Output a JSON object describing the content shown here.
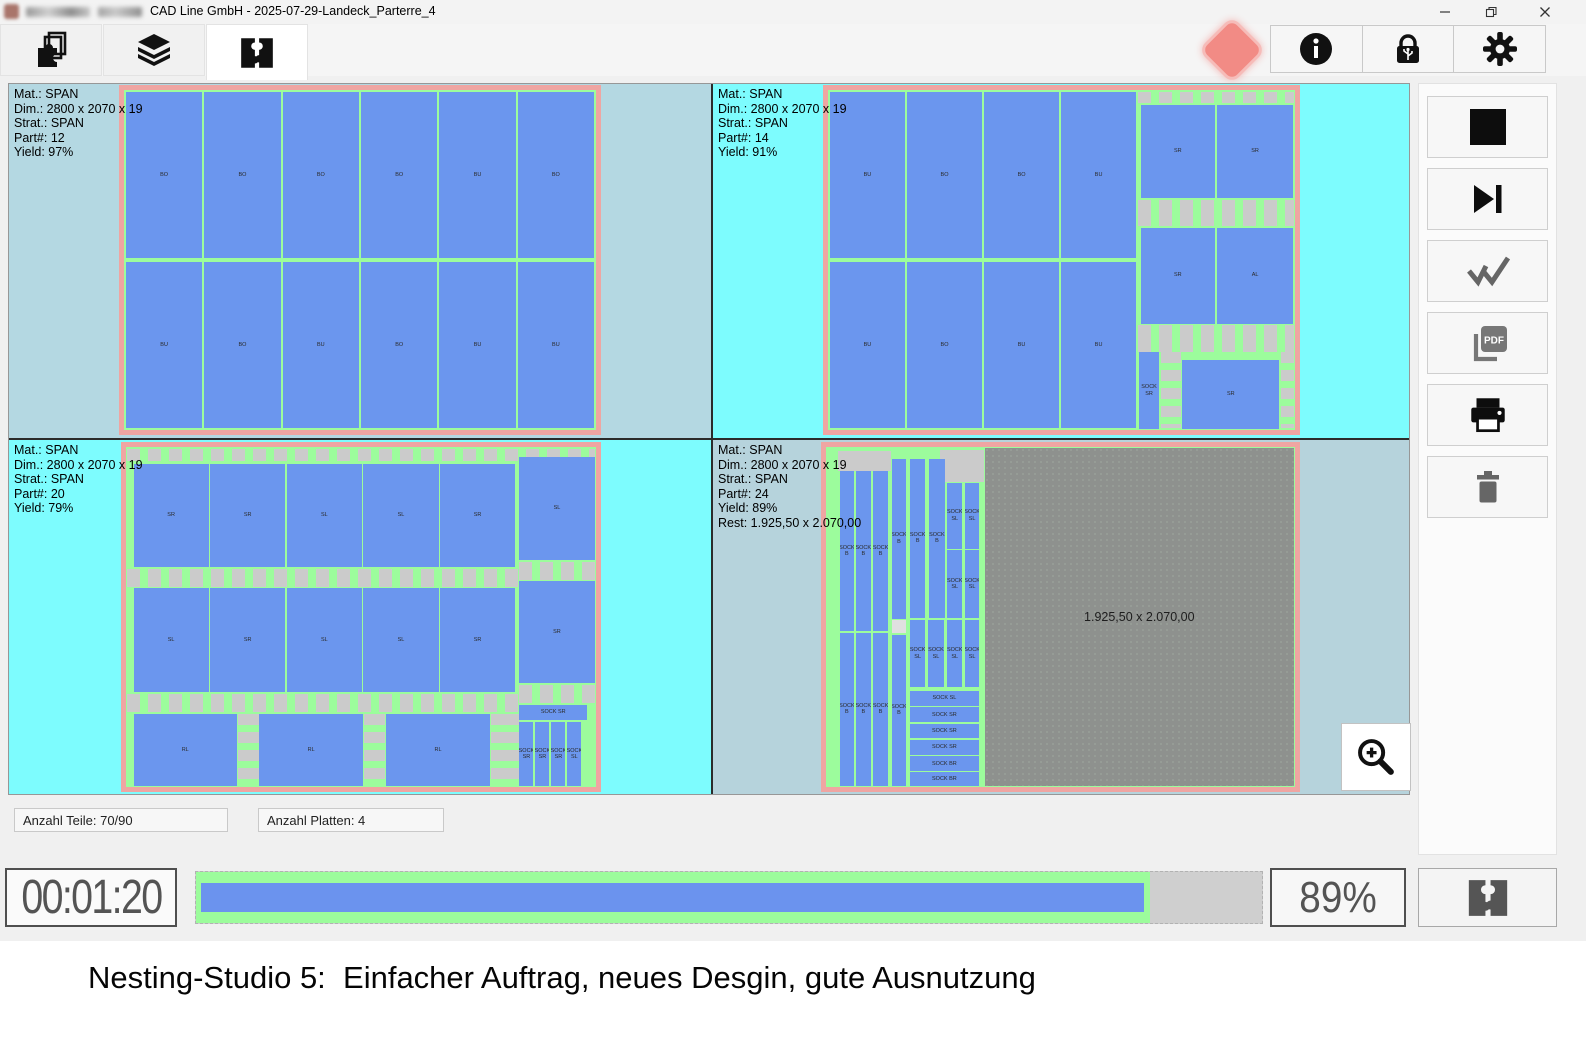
{
  "window": {
    "title": "CAD Line GmbH - 2025-07-29-Landeck_Parterre_4",
    "controls": [
      {
        "icon": "minimize-icon"
      },
      {
        "icon": "restore-icon"
      },
      {
        "icon": "close-icon"
      }
    ]
  },
  "toolbar": {
    "tabs": [
      {
        "icon": "nesting-parts-icon",
        "active": false
      },
      {
        "icon": "material-layers-icon",
        "active": false
      },
      {
        "icon": "nesting-puzzle-icon",
        "active": true
      }
    ],
    "status_indicator_color": "#f28b85",
    "buttons": [
      {
        "icon": "info-icon"
      },
      {
        "icon": "usb-lock-icon"
      },
      {
        "icon": "settings-gear-icon"
      }
    ]
  },
  "sheets": [
    {
      "info": [
        "Mat.: SPAN",
        "Dim.: 2800 x 2070 x 19",
        "Strat.: SPAN",
        "Part#: 12",
        "Yield: 97%"
      ],
      "rects": [
        {
          "t": "p",
          "x": 0.4,
          "y": 0.6,
          "w": 16.2,
          "h": 48.9,
          "l": "BO"
        },
        {
          "t": "p",
          "x": 17.0,
          "y": 0.6,
          "w": 16.2,
          "h": 48.9,
          "l": "BO"
        },
        {
          "t": "p",
          "x": 33.6,
          "y": 0.6,
          "w": 16.2,
          "h": 48.9,
          "l": "BO"
        },
        {
          "t": "p",
          "x": 50.2,
          "y": 0.6,
          "w": 16.2,
          "h": 48.9,
          "l": "BO"
        },
        {
          "t": "p",
          "x": 66.8,
          "y": 0.6,
          "w": 16.2,
          "h": 48.9,
          "l": "BU"
        },
        {
          "t": "p",
          "x": 83.4,
          "y": 0.6,
          "w": 16.2,
          "h": 48.9,
          "l": "BO"
        },
        {
          "t": "p",
          "x": 0.4,
          "y": 50.5,
          "w": 16.2,
          "h": 48.9,
          "l": "BU"
        },
        {
          "t": "p",
          "x": 17.0,
          "y": 50.5,
          "w": 16.2,
          "h": 48.9,
          "l": "BO"
        },
        {
          "t": "p",
          "x": 33.6,
          "y": 50.5,
          "w": 16.2,
          "h": 48.9,
          "l": "BU"
        },
        {
          "t": "p",
          "x": 50.2,
          "y": 50.5,
          "w": 16.2,
          "h": 48.9,
          "l": "BO"
        },
        {
          "t": "p",
          "x": 66.8,
          "y": 50.5,
          "w": 16.2,
          "h": 48.9,
          "l": "BU"
        },
        {
          "t": "p",
          "x": 83.4,
          "y": 50.5,
          "w": 16.2,
          "h": 48.9,
          "l": "BU"
        }
      ]
    },
    {
      "info": [
        "Mat.: SPAN",
        "Dim.: 2800 x 2070 x 19",
        "Strat.: SPAN",
        "Part#: 14",
        "Yield: 91%"
      ],
      "rects": [
        {
          "t": "c",
          "x": 66.4,
          "y": 0.5,
          "w": 33.3,
          "h": 3.4
        },
        {
          "t": "c",
          "x": 66.4,
          "y": 32.3,
          "w": 33.3,
          "h": 7.8
        },
        {
          "t": "c",
          "x": 66.4,
          "y": 69.1,
          "w": 33.3,
          "h": 7.9
        },
        {
          "t": "v",
          "x": 71.3,
          "y": 77.2,
          "w": 4.2,
          "h": 22.3
        },
        {
          "t": "v",
          "x": 96.9,
          "y": 77.2,
          "w": 2.8,
          "h": 22.3
        },
        {
          "t": "p",
          "x": 0.4,
          "y": 0.6,
          "w": 16.1,
          "h": 48.9,
          "l": "BU"
        },
        {
          "t": "p",
          "x": 16.9,
          "y": 0.6,
          "w": 16.1,
          "h": 48.9,
          "l": "BO"
        },
        {
          "t": "p",
          "x": 33.4,
          "y": 0.6,
          "w": 16.1,
          "h": 48.9,
          "l": "BO"
        },
        {
          "t": "p",
          "x": 49.9,
          "y": 0.6,
          "w": 16.1,
          "h": 48.9,
          "l": "BU"
        },
        {
          "t": "p",
          "x": 0.4,
          "y": 50.5,
          "w": 16.1,
          "h": 48.9,
          "l": "BU"
        },
        {
          "t": "p",
          "x": 16.9,
          "y": 50.5,
          "w": 16.1,
          "h": 48.9,
          "l": "BO"
        },
        {
          "t": "p",
          "x": 33.4,
          "y": 50.5,
          "w": 16.1,
          "h": 48.9,
          "l": "BU"
        },
        {
          "t": "p",
          "x": 49.9,
          "y": 50.5,
          "w": 16.1,
          "h": 48.9,
          "l": "BU"
        },
        {
          "t": "p",
          "x": 67.0,
          "y": 4.3,
          "w": 15.8,
          "h": 27.6,
          "l": "SR"
        },
        {
          "t": "p",
          "x": 83.3,
          "y": 4.3,
          "w": 16.3,
          "h": 27.6,
          "l": "SR"
        },
        {
          "t": "p",
          "x": 67.0,
          "y": 40.5,
          "w": 15.8,
          "h": 28.2,
          "l": "SR"
        },
        {
          "t": "p",
          "x": 83.3,
          "y": 40.5,
          "w": 16.3,
          "h": 28.2,
          "l": "AL"
        },
        {
          "t": "p",
          "x": 66.6,
          "y": 77.2,
          "w": 4.3,
          "h": 22.4,
          "l": "SOCK SR"
        },
        {
          "t": "p",
          "x": 75.9,
          "y": 79.5,
          "w": 20.7,
          "h": 20.1,
          "l": "SR"
        }
      ]
    },
    {
      "info": [
        "Mat.: SPAN",
        "Dim.: 2800 x 2070 x 19",
        "Strat.: SPAN",
        "Part#: 20",
        "Yield: 79%"
      ],
      "rects": [
        {
          "t": "c",
          "x": 0.3,
          "y": 0.5,
          "w": 99.4,
          "h": 3.7
        },
        {
          "t": "c",
          "x": 0.3,
          "y": 35.8,
          "w": 83.2,
          "h": 5.4
        },
        {
          "t": "c",
          "x": 83.7,
          "y": 33.8,
          "w": 16.0,
          "h": 5.2
        },
        {
          "t": "c",
          "x": 0.3,
          "y": 72.6,
          "w": 83.2,
          "h": 5.4
        },
        {
          "t": "c",
          "x": 83.7,
          "y": 70.0,
          "w": 16.0,
          "h": 5.2
        },
        {
          "t": "v",
          "x": 23.8,
          "y": 78.6,
          "w": 4.4,
          "h": 21.0
        },
        {
          "t": "v",
          "x": 50.6,
          "y": 78.6,
          "w": 4.6,
          "h": 21.0
        },
        {
          "t": "v",
          "x": 77.6,
          "y": 78.6,
          "w": 6.0,
          "h": 21.0
        },
        {
          "t": "p",
          "x": 1.6,
          "y": 4.9,
          "w": 16.0,
          "h": 30.3,
          "l": "SR"
        },
        {
          "t": "p",
          "x": 17.9,
          "y": 4.9,
          "w": 16.0,
          "h": 30.3,
          "l": "SR"
        },
        {
          "t": "p",
          "x": 34.2,
          "y": 4.9,
          "w": 16.0,
          "h": 30.3,
          "l": "SL"
        },
        {
          "t": "p",
          "x": 50.5,
          "y": 4.9,
          "w": 16.0,
          "h": 30.3,
          "l": "SL"
        },
        {
          "t": "p",
          "x": 66.8,
          "y": 4.9,
          "w": 16.0,
          "h": 30.3,
          "l": "SR"
        },
        {
          "t": "p",
          "x": 83.7,
          "y": 2.8,
          "w": 16.0,
          "h": 30.5,
          "l": "SL"
        },
        {
          "t": "p",
          "x": 1.6,
          "y": 41.6,
          "w": 16.0,
          "h": 30.4,
          "l": "SL"
        },
        {
          "t": "p",
          "x": 17.9,
          "y": 41.6,
          "w": 16.0,
          "h": 30.4,
          "l": "SR"
        },
        {
          "t": "p",
          "x": 34.2,
          "y": 41.6,
          "w": 16.0,
          "h": 30.4,
          "l": "SL"
        },
        {
          "t": "p",
          "x": 50.5,
          "y": 41.6,
          "w": 16.0,
          "h": 30.4,
          "l": "SL"
        },
        {
          "t": "p",
          "x": 66.8,
          "y": 41.6,
          "w": 16.0,
          "h": 30.4,
          "l": "SR"
        },
        {
          "t": "p",
          "x": 83.7,
          "y": 39.5,
          "w": 16.0,
          "h": 30.0,
          "l": "SR"
        },
        {
          "t": "p",
          "x": 1.6,
          "y": 78.6,
          "w": 22.0,
          "h": 21.0,
          "l": "RL"
        },
        {
          "t": "p",
          "x": 28.4,
          "y": 78.6,
          "w": 22.0,
          "h": 21.0,
          "l": "RL"
        },
        {
          "t": "p",
          "x": 55.4,
          "y": 78.6,
          "w": 22.0,
          "h": 21.0,
          "l": "RL"
        },
        {
          "t": "p",
          "x": 83.7,
          "y": 75.8,
          "w": 14.4,
          "h": 4.4,
          "l": "SOCK SR"
        },
        {
          "t": "p",
          "x": 83.7,
          "y": 80.8,
          "w": 3.0,
          "h": 19.0,
          "l": "SOCK SR"
        },
        {
          "t": "p",
          "x": 87.1,
          "y": 80.8,
          "w": 3.0,
          "h": 19.0,
          "l": "SOCK SR"
        },
        {
          "t": "p",
          "x": 90.5,
          "y": 80.8,
          "w": 3.0,
          "h": 19.0,
          "l": "SOCK SR"
        },
        {
          "t": "p",
          "x": 93.9,
          "y": 80.8,
          "w": 3.0,
          "h": 19.0,
          "l": "SOCK SL"
        }
      ]
    },
    {
      "info": [
        "Mat.: SPAN",
        "Dim.: 2800 x 2070 x 19",
        "Strat.: SPAN",
        "Part#: 24",
        "Yield: 89%",
        "Rest: 1.925,50 x 2.070,00"
      ],
      "rects": [
        {
          "t": "r",
          "x": 33.8,
          "y": 0.3,
          "w": 66.0,
          "h": 99.4,
          "l": "1.925,50 x 2.070,00"
        },
        {
          "t": "w",
          "x": 2.6,
          "y": 1.2,
          "w": 11.2,
          "h": 6.0
        },
        {
          "t": "w",
          "x": 24.4,
          "y": 0.8,
          "w": 9.2,
          "h": 9.6
        },
        {
          "t": "l",
          "x": 14.0,
          "y": 50.8,
          "w": 3.1,
          "h": 3.8
        },
        {
          "t": "p",
          "x": 2.9,
          "y": 7.1,
          "w": 3.1,
          "h": 46.9,
          "l": "SOCK B"
        },
        {
          "t": "p",
          "x": 6.4,
          "y": 7.1,
          "w": 3.1,
          "h": 46.9,
          "l": "SOCK B"
        },
        {
          "t": "p",
          "x": 10.1,
          "y": 7.1,
          "w": 3.1,
          "h": 46.9,
          "l": "SOCK B"
        },
        {
          "t": "p",
          "x": 14.0,
          "y": 3.4,
          "w": 3.1,
          "h": 47.2,
          "l": "SOCK B"
        },
        {
          "t": "p",
          "x": 17.9,
          "y": 3.4,
          "w": 3.3,
          "h": 46.9,
          "l": "SOCK B"
        },
        {
          "t": "p",
          "x": 22.0,
          "y": 3.4,
          "w": 3.3,
          "h": 46.9,
          "l": "SOCK B"
        },
        {
          "t": "p",
          "x": 25.9,
          "y": 10.5,
          "w": 3.1,
          "h": 19.4,
          "l": "SOCK SL"
        },
        {
          "t": "p",
          "x": 25.9,
          "y": 30.3,
          "w": 3.1,
          "h": 20.0,
          "l": "SOCK SL"
        },
        {
          "t": "p",
          "x": 29.6,
          "y": 10.5,
          "w": 3.1,
          "h": 19.4,
          "l": "SOCK SL"
        },
        {
          "t": "p",
          "x": 29.6,
          "y": 30.3,
          "w": 3.1,
          "h": 20.0,
          "l": "SOCK SL"
        },
        {
          "t": "p",
          "x": 2.9,
          "y": 54.8,
          "w": 3.1,
          "h": 44.8,
          "l": "SOCK B"
        },
        {
          "t": "p",
          "x": 6.4,
          "y": 54.8,
          "w": 3.1,
          "h": 44.8,
          "l": "SOCK B"
        },
        {
          "t": "p",
          "x": 10.1,
          "y": 54.8,
          "w": 3.1,
          "h": 44.8,
          "l": "SOCK B"
        },
        {
          "t": "p",
          "x": 14.0,
          "y": 55.2,
          "w": 3.1,
          "h": 44.4,
          "l": "SOCK B"
        },
        {
          "t": "p",
          "x": 17.9,
          "y": 51.0,
          "w": 3.3,
          "h": 19.6,
          "l": "SOCK SL"
        },
        {
          "t": "p",
          "x": 21.8,
          "y": 51.0,
          "w": 3.3,
          "h": 19.6,
          "l": "SOCK SL"
        },
        {
          "t": "p",
          "x": 25.9,
          "y": 51.0,
          "w": 3.1,
          "h": 19.6,
          "l": "SOCK SL"
        },
        {
          "t": "p",
          "x": 29.6,
          "y": 51.0,
          "w": 3.1,
          "h": 19.6,
          "l": "SOCK SL"
        },
        {
          "t": "p",
          "x": 17.9,
          "y": 71.8,
          "w": 14.7,
          "h": 4.3,
          "l": "SOCK SL"
        },
        {
          "t": "p",
          "x": 17.9,
          "y": 76.6,
          "w": 14.7,
          "h": 4.3,
          "l": "SOCK SR"
        },
        {
          "t": "p",
          "x": 17.9,
          "y": 81.4,
          "w": 14.7,
          "h": 4.3,
          "l": "SOCK SR"
        },
        {
          "t": "p",
          "x": 17.9,
          "y": 86.2,
          "w": 14.7,
          "h": 4.3,
          "l": "SOCK SR"
        },
        {
          "t": "p",
          "x": 17.9,
          "y": 91.0,
          "w": 14.7,
          "h": 4.3,
          "l": "SOCK BR"
        },
        {
          "t": "p",
          "x": 17.9,
          "y": 95.7,
          "w": 14.7,
          "h": 4.0,
          "l": "SOCK BR"
        }
      ]
    }
  ],
  "side_buttons": [
    {
      "icon": "stop-icon"
    },
    {
      "icon": "skip-next-icon"
    },
    {
      "icon": "double-check-icon"
    },
    {
      "icon": "pdf-export-icon"
    },
    {
      "icon": "print-icon"
    },
    {
      "icon": "delete-icon"
    }
  ],
  "zoom_button": {
    "icon": "zoom-in-icon"
  },
  "status_fields": {
    "parts": "Anzahl Teile: 70/90",
    "sheets": "Anzahl Platten: 4"
  },
  "bottom_bar": {
    "elapsed": "00:01:20",
    "progress_percent": 89.5,
    "percent_label": "89%",
    "run_icon": "nesting-puzzle-icon"
  },
  "caption": {
    "text": "Nesting-Studio 5:  Einfacher Auftrag, neues Desgin, gute Ausnutzung"
  },
  "colors": {
    "part_blue": "#6b96ee",
    "gap_green": "#9cfc9c",
    "waste_gray": "#cbcbcb",
    "rest_gray": "#8e918e",
    "board_border_salmon": "#efa5a2",
    "bg_bright_cyan": "#7dfcfe",
    "bg_pale_blue": "#b4d8e2",
    "status_red": "#f28b85"
  }
}
